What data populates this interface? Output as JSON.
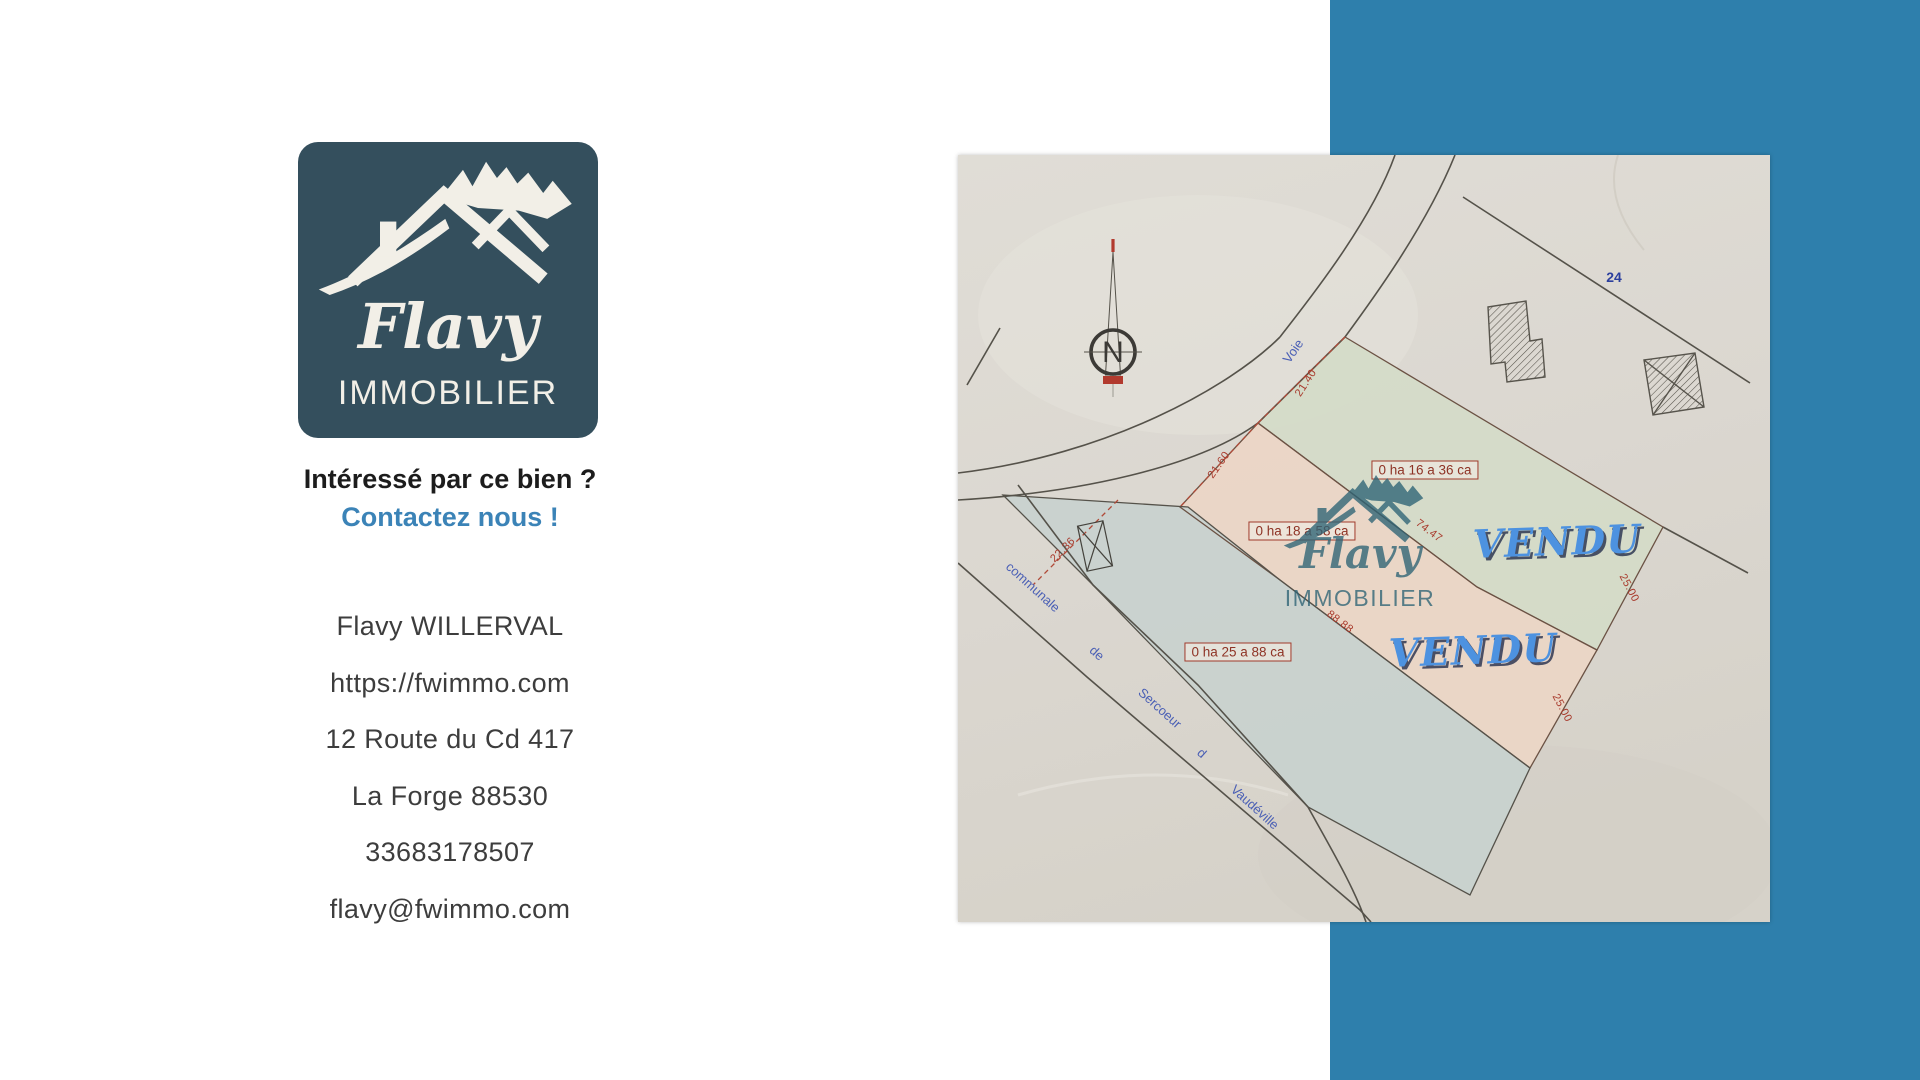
{
  "brand": {
    "name": "Flavy",
    "type": "IMMOBILIER"
  },
  "cta": {
    "line1": "Intéressé par ce bien ?",
    "line2": "Contactez nous !"
  },
  "contact": {
    "lines": [
      "Flavy WILLERVAL",
      "https://fwimmo.com",
      "12 Route du Cd 417",
      "La Forge 88530",
      "33683178507",
      "flavy@fwimmo.com"
    ]
  },
  "map": {
    "north": "N",
    "parcel_number": "24",
    "sold": "VENDU",
    "areas": {
      "green": "0 ha 16 a 36 ca",
      "pink": "0 ha 18 a 58 ca",
      "blue": "0 ha 25 a 88 ca"
    },
    "roads": {
      "voie": "Voie",
      "communale": "communale",
      "de": "de",
      "sercoeur": "Sercoeur",
      "d": "d",
      "vaudeville": "Vaudéville"
    },
    "measures": {
      "m2140": "21.40",
      "m2160": "21.60",
      "m2236": "22.36",
      "m7447": "74.47",
      "m8888": "88.88",
      "m2500a": "25.00",
      "m2500b": "25.00"
    }
  },
  "colors": {
    "band_blue": "#2e7fac",
    "logo_bg": "#344f5d",
    "logo_fg": "#f2efe7",
    "accent_blue": "#3b83b7",
    "vendu_blue": "#4d92e0",
    "watermark_teal": "#2d6375",
    "paper": "#dcd8d1",
    "parcel_green": "#d4dbc8",
    "parcel_pink": "#ecd6c6",
    "parcel_blue": "#c8d1ce",
    "plan_red": "#a8392b",
    "road_label_blue": "#4a5fb5"
  }
}
